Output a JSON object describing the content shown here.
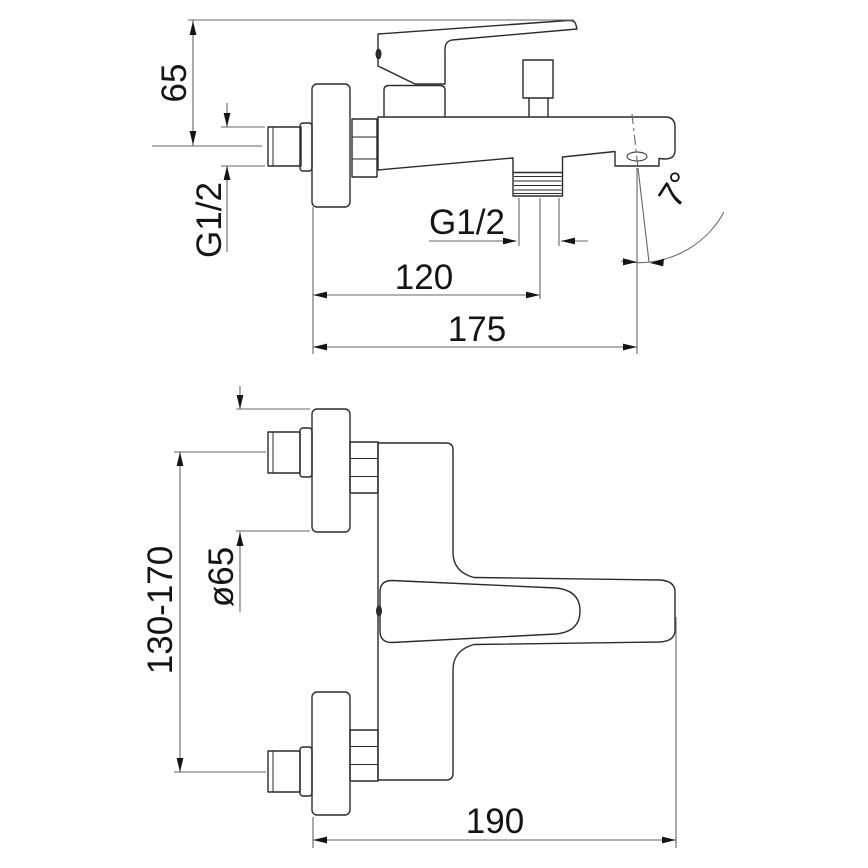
{
  "drawing": {
    "subject": "Wall-mounted bathtub mixer faucet — dimensional technical drawing with two orthographic views",
    "side_view": {
      "height_to_handle": "65",
      "inlet_thread": "G1/2",
      "shower_outlet_thread": "G1/2",
      "wall_to_shower_outlet": "120",
      "wall_to_spout_tip": "175",
      "spout_angle": "7°"
    },
    "plan_view": {
      "escutcheon_diameter": "ø65",
      "inlet_centers_range": "130-170",
      "overall_projection": "190"
    },
    "colors": {
      "outline": "#2b2b2b",
      "dimension": "#666666",
      "text": "#141414",
      "background": "#ffffff"
    }
  }
}
